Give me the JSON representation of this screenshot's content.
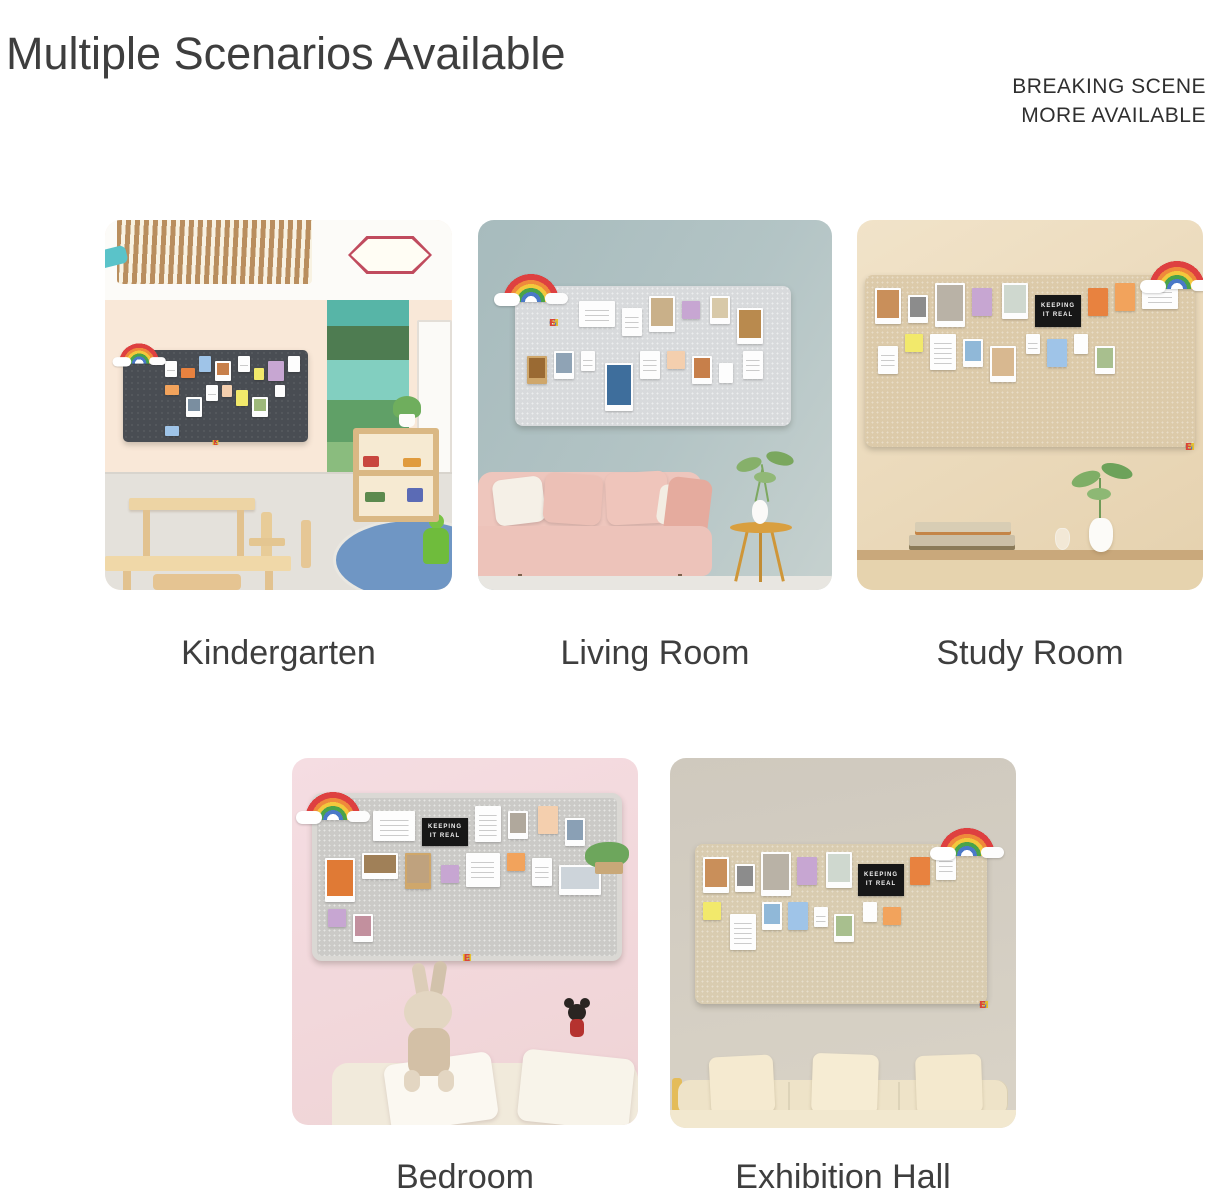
{
  "header": {
    "title": "Multiple Scenarios Available",
    "tagline_line1": "BREAKING SCENE",
    "tagline_line2": "MORE AVAILABLE"
  },
  "board": {
    "sign": "KEEPING IT REAL",
    "letters": [
      "H",
      "O",
      "M",
      "E"
    ]
  },
  "scenes": [
    {
      "label": "Kindergarten"
    },
    {
      "label": "Living Room"
    },
    {
      "label": "Study Room"
    },
    {
      "label": "Bedroom"
    },
    {
      "label": "Exhibition Hall"
    }
  ],
  "palette": {
    "title_text": "#3e3e3e",
    "label_text": "#3e3e3e",
    "board_dark_felt": "#494d53",
    "board_gray_felt": "#d8dadc",
    "board_tan_felt": "#dccaa9",
    "wall_peach": "#f9e8d8",
    "wall_blue_gray": "#aebfc1",
    "wall_beige": "#ead8bb",
    "wall_pink": "#f4dbe1",
    "wall_greige": "#d1cabf"
  }
}
